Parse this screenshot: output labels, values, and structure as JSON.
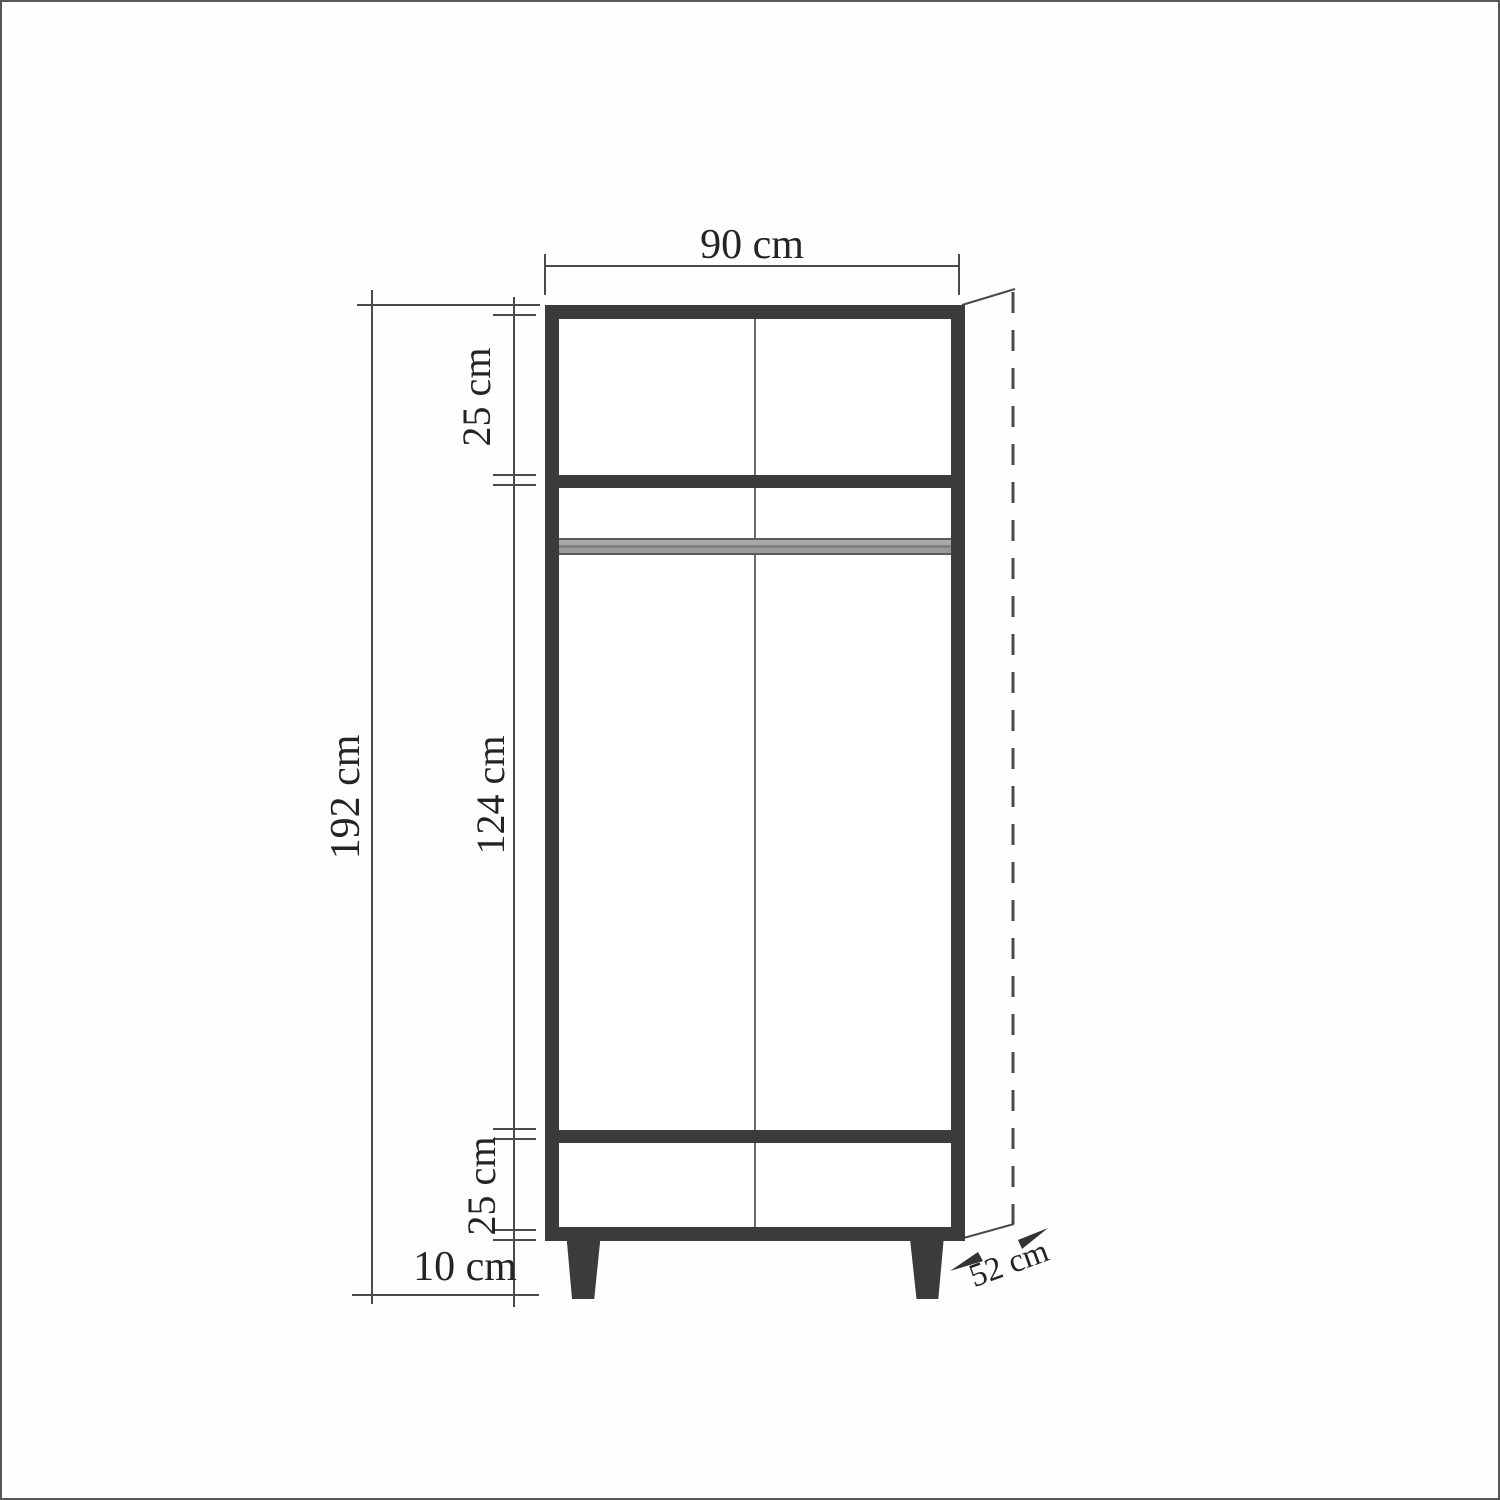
{
  "drawing": {
    "type": "furniture-dimension-diagram",
    "subject": "two-door wardrobe front elevation with dimension lines",
    "dimensions": {
      "width": "90 cm",
      "height": "192 cm",
      "top_section": "25 cm",
      "middle_section": "124 cm",
      "drawer_section": "25 cm",
      "leg_height": "10 cm",
      "depth": "52 cm"
    },
    "colors": {
      "outline": "#3b3b3b",
      "line": "#4a4a4a",
      "rod": "#9c9c9c",
      "divider": "#6b6b6b",
      "background": "#ffffff",
      "text": "#242424"
    }
  }
}
